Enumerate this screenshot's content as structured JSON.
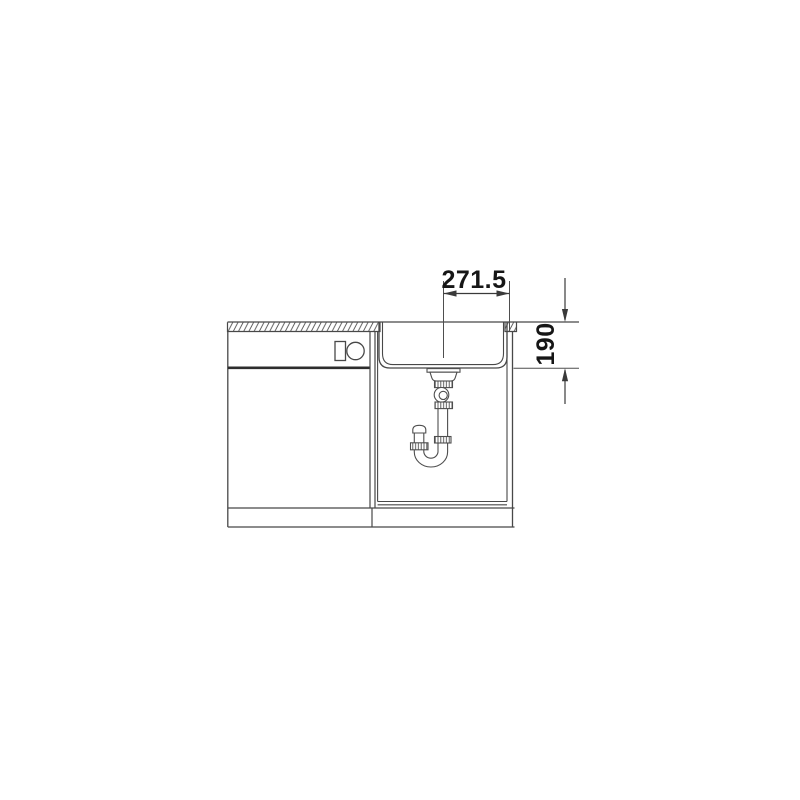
{
  "dimensions": {
    "width_mm": "271.5",
    "depth_mm": "190"
  },
  "colors": {
    "background": "#ffffff",
    "line": "#484848",
    "dark_line": "#2d2d2d",
    "text": "#161616"
  },
  "icons": [
    "worktop-hatch",
    "dishwasher-controls",
    "sink-bowl",
    "drain-siphon-trap",
    "dimension-arrows"
  ]
}
